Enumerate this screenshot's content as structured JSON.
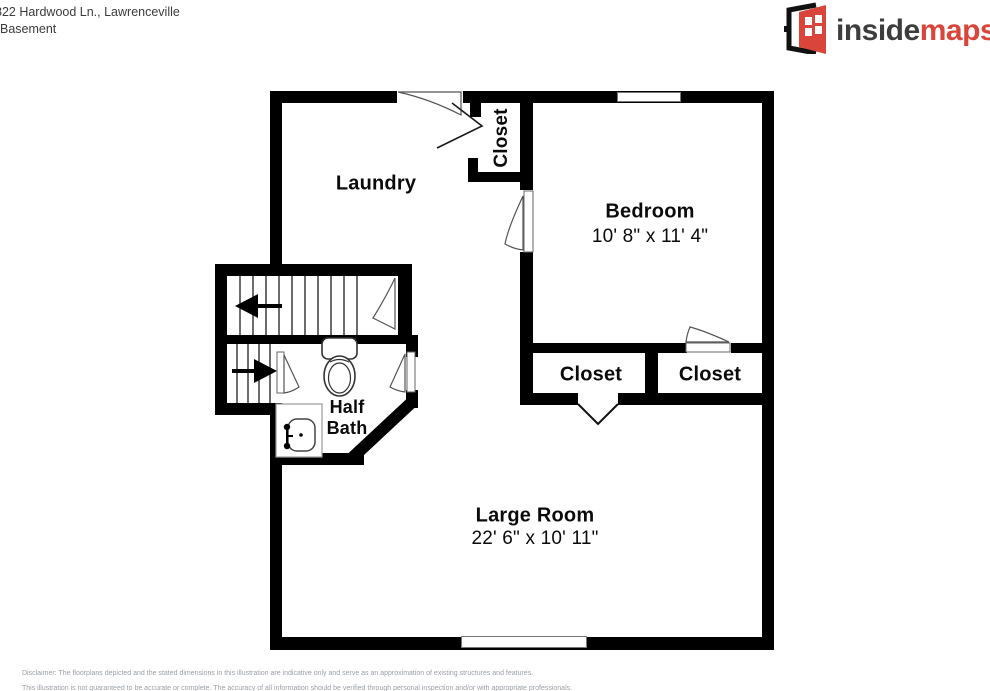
{
  "header": {
    "address": "822 Hardwood Ln., Lawrenceville",
    "floor_label": "Basement"
  },
  "logo": {
    "inside": "inside",
    "maps": "maps",
    "brand_color": "#d9453b",
    "icon": "open-door-icon"
  },
  "floorplan": {
    "rooms": {
      "laundry": {
        "label": "Laundry"
      },
      "hall_closet": {
        "label": "Closet"
      },
      "bedroom": {
        "label": "Bedroom",
        "dims": "10' 8\" x 11' 4\""
      },
      "bedroom_closet_left": {
        "label": "Closet"
      },
      "bedroom_closet_right": {
        "label": "Closet"
      },
      "half_bath": {
        "line1": "Half",
        "line2": "Bath"
      },
      "large_room": {
        "label": "Large Room",
        "dims": "22' 6\" x 10' 11\""
      }
    },
    "fixtures": {
      "toilet": "toilet-icon",
      "sink": "sink-icon",
      "stairs_upper_arrow": "arrow-left-icon",
      "stairs_lower_arrow": "arrow-right-icon",
      "windows": 2,
      "wall_color": "#000000"
    }
  },
  "footer": {
    "line1": "Disclaimer: The floorplans depicted and the stated dimensions in this illustration are indicative only and serve as an approximation of existing structures and features.",
    "line2": "This illustration is not guaranteed to be accurate or complete. The accuracy of all information should be verified through personal inspection and/or with appropriate professionals."
  }
}
